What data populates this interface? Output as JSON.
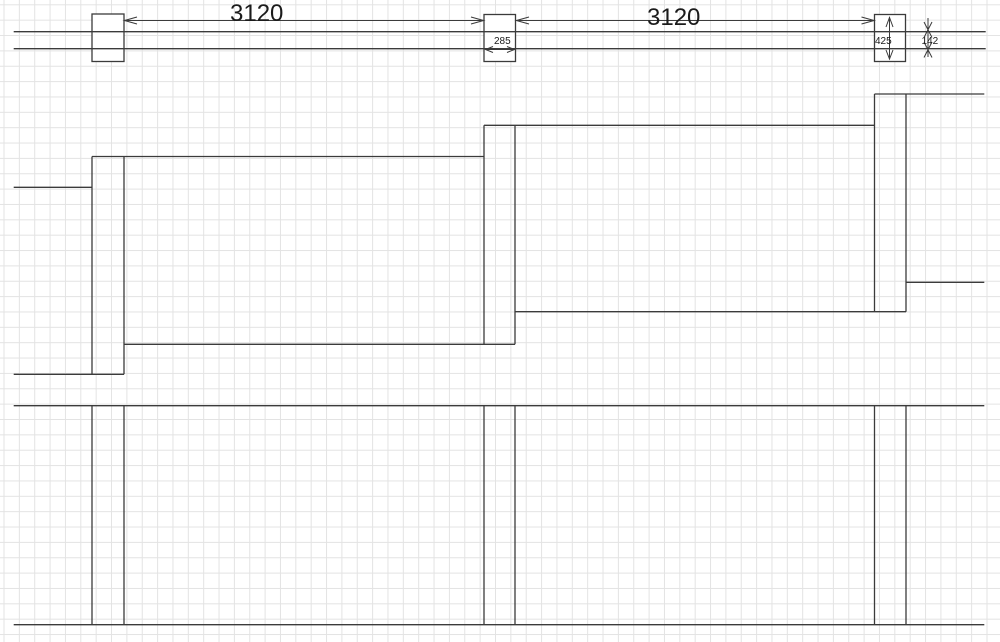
{
  "drawing": {
    "type": "technical-plan",
    "dimension_labels": {
      "span_left": "3120",
      "span_right": "3120",
      "post_width": "285",
      "post_depth": "425",
      "rail_gap": "142"
    },
    "colors": {
      "line": "#3b3b3b",
      "grid_line": "#e3e3e3",
      "background": "#ffffff",
      "text": "#1b1b1b"
    }
  }
}
